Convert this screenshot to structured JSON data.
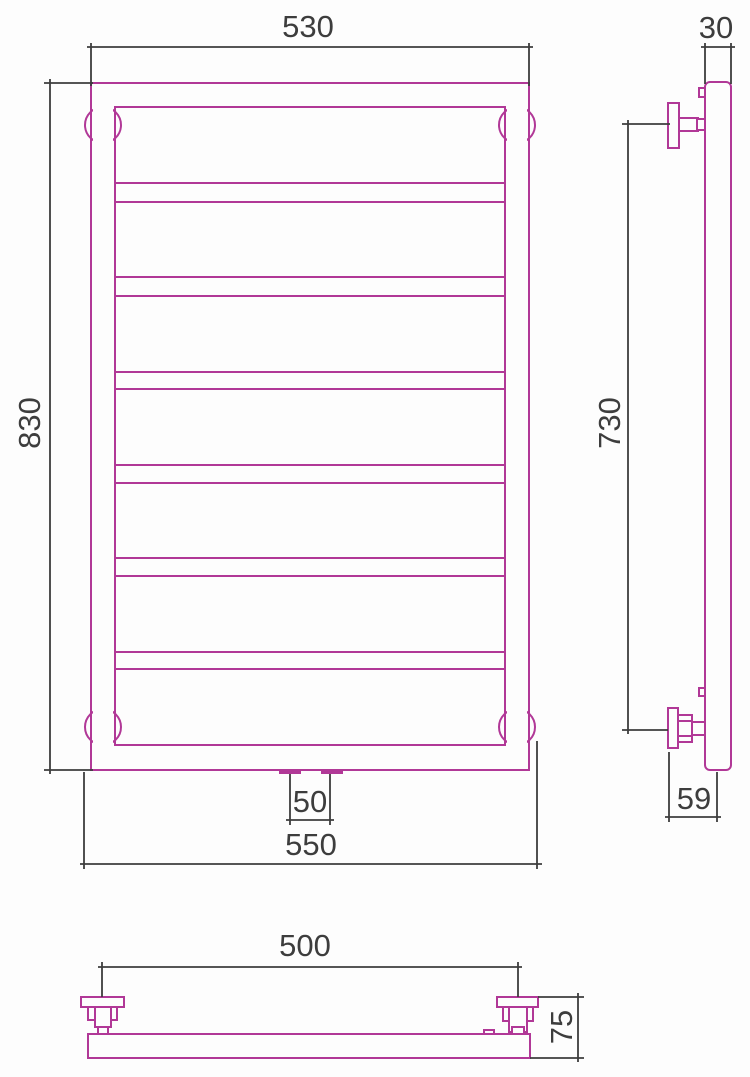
{
  "drawing": {
    "kind": "technical dimension drawing",
    "subject": "ladder towel rail (front, side and top views)"
  },
  "colors": {
    "product_outline": "#b13897",
    "dimension_lines": "#3d3d3d",
    "background": "#fdfdfd"
  },
  "dimensions": {
    "front_overall_width": "530",
    "front_overall_height": "830",
    "front_bottom_width": "550",
    "front_connection_spacing": "50",
    "side_tube_width": "30",
    "side_bracket_span": "730",
    "side_wall_to_axis": "59",
    "top_bracket_span": "500",
    "top_overall_depth": "75"
  }
}
